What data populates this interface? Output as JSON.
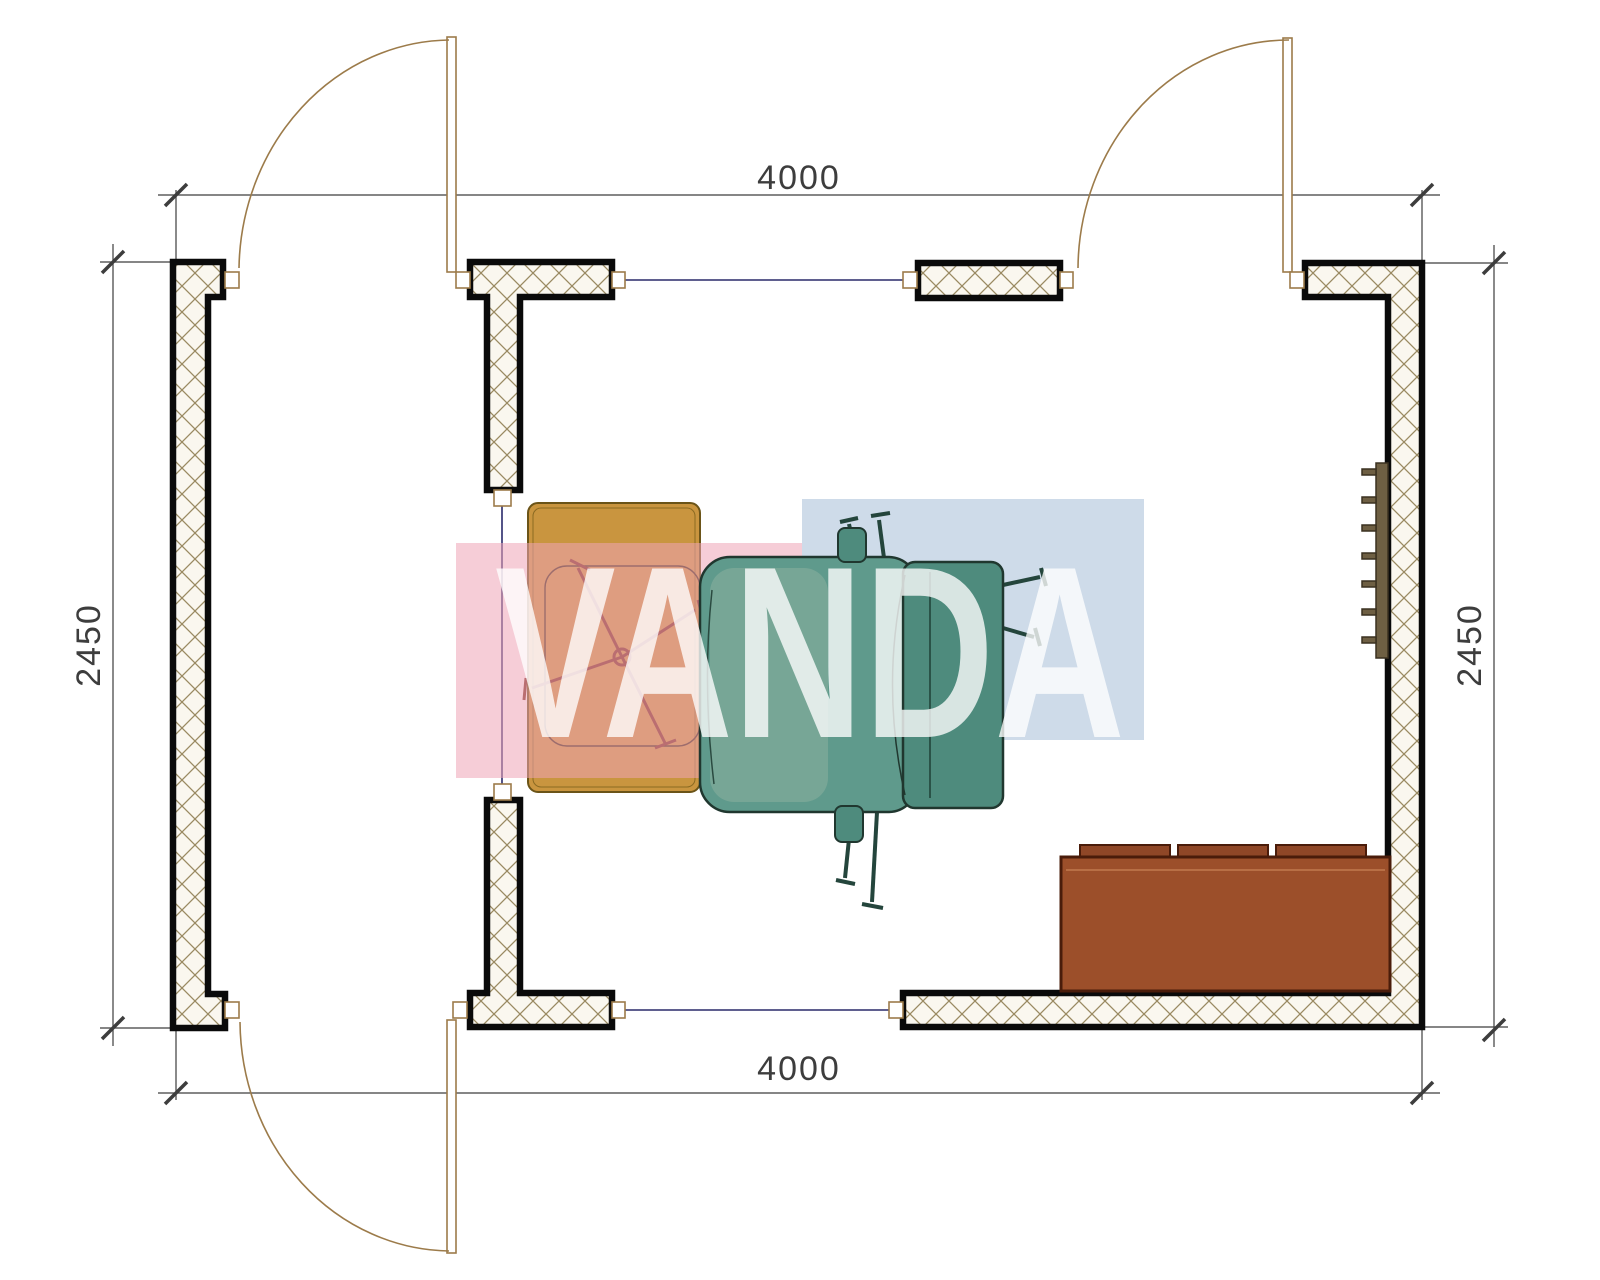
{
  "drawing": {
    "type": "floor-plan",
    "dimensions": {
      "top": "4000",
      "bottom": "4000",
      "left": "2450",
      "right": "2450"
    },
    "watermark": {
      "text": "VANDA",
      "pink_block": "#eea4b7",
      "blue_block": "#9eb7d4",
      "letter_color": "#ffffff"
    },
    "colors": {
      "wall_outline": "#0a0a0a",
      "wall_hatch": "#9a8a62",
      "wall_fill": "#faf7ef",
      "door": "#9c7b4a",
      "window_line": "#2a2a6a",
      "dimension_line": "#3d3d3d",
      "desk": "#c9953f",
      "chair_seat": "#5f9a8c",
      "chair_back": "#4e8b7d",
      "chair_base_cross": "#7a2d1d",
      "sofa": "#9c4f2a",
      "radiator": "#6e5f43"
    },
    "icons": [
      "desk-icon",
      "desk-chair-base-icon",
      "office-chair-icon",
      "sofa-icon",
      "radiator-icon",
      "door-swing-icon",
      "window-icon"
    ],
    "counts": {
      "doors": 3,
      "windows": 3
    }
  }
}
